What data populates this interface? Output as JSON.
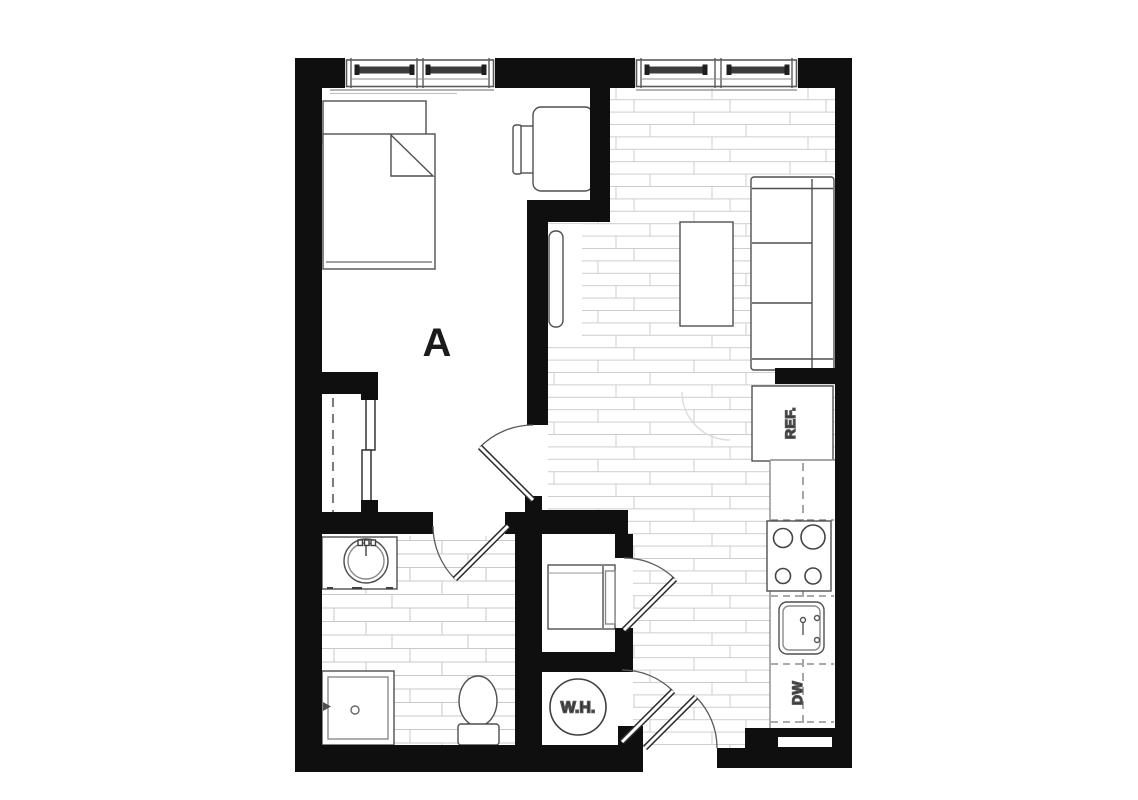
{
  "floor_plan": {
    "unit_label": "A",
    "appliance_labels": {
      "refrigerator": "REF.",
      "dishwasher": "DW",
      "water_heater": "W.H."
    },
    "colors": {
      "wall": "#0f0f0f",
      "furniture_line": "#4f4f4f",
      "floor_line": "#cdcdcd",
      "background": "#ffffff"
    }
  }
}
